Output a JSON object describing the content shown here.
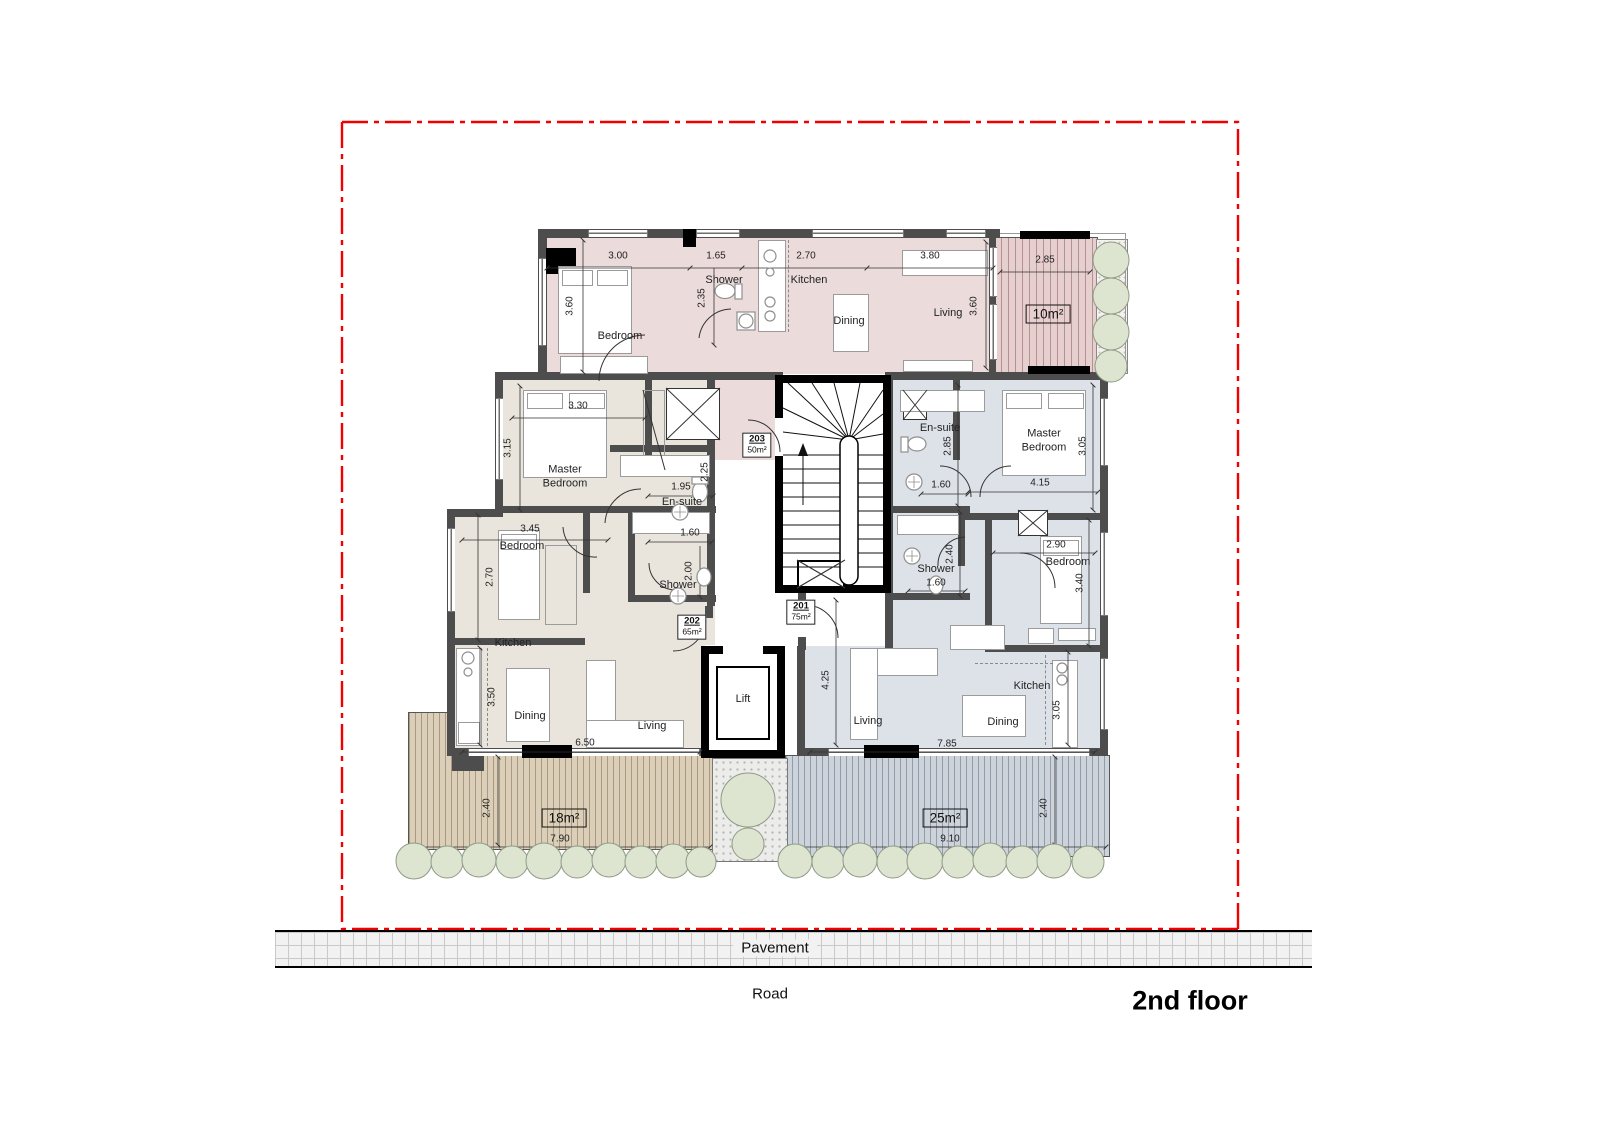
{
  "title": "2nd floor",
  "site": {
    "pavement": "Pavement",
    "road": "Road"
  },
  "lift_label": "Lift",
  "colors": {
    "apt203": "#ecdbdb",
    "apt202": "#e9e5dd",
    "apt201": "#dde2e8",
    "boundary": "#f20000"
  },
  "units": {
    "u203": {
      "number": "203",
      "area": "50m²"
    },
    "u202": {
      "number": "202",
      "area": "65m²"
    },
    "u201": {
      "number": "201",
      "area": "75m²"
    }
  },
  "balconies": {
    "top": "10m²",
    "left": "18m²",
    "right": "25m²"
  },
  "rooms": {
    "a203": {
      "bedroom": "Bedroom",
      "shower": "Shower",
      "kitchen": "Kitchen",
      "dining": "Dining",
      "living": "Living"
    },
    "a202": {
      "master": "Master Bedroom",
      "ensuite": "En-suite",
      "bedroom": "Bedroom",
      "shower": "Shower",
      "kitchen": "Kitchen",
      "dining": "Dining",
      "living": "Living"
    },
    "a201": {
      "ensuite": "En-suite",
      "master": "Master Bedroom",
      "shower": "Shower",
      "bedroom": "Bedroom",
      "living": "Living",
      "dining": "Dining",
      "kitchen": "Kitchen"
    }
  },
  "dims": {
    "a203": {
      "bedroom_w": "3.00",
      "left_h": "3.60",
      "shower_w": "1.65",
      "shower_h": "2.35",
      "kitchen_w": "2.70",
      "living_w": "3.80",
      "right_h": "3.60",
      "balcony_w": "2.85"
    },
    "a202": {
      "master_w": "3.30",
      "master_h": "3.15",
      "ensuite_w": "1.95",
      "ensuite_h": "2.25",
      "bedroom_w": "3.45",
      "bedroom_h": "2.70",
      "shower_w": "1.60",
      "shower_h": "2.00",
      "kitchen_h": "3.50",
      "living_w": "6.50",
      "balcony_w": "7.90",
      "balcony_h": "2.40"
    },
    "a201": {
      "ensuite_h": "2.85",
      "ensuite_w": "1.60",
      "master_w": "4.15",
      "master_h": "3.05",
      "shower_h": "2.40",
      "shower_w": "1.60",
      "bedroom_w": "2.90",
      "bedroom_h": "3.40",
      "living_h": "4.25",
      "living_w": "7.85",
      "kitchen_h": "3.05",
      "balcony_w": "9.10",
      "balcony_h": "2.40"
    }
  }
}
